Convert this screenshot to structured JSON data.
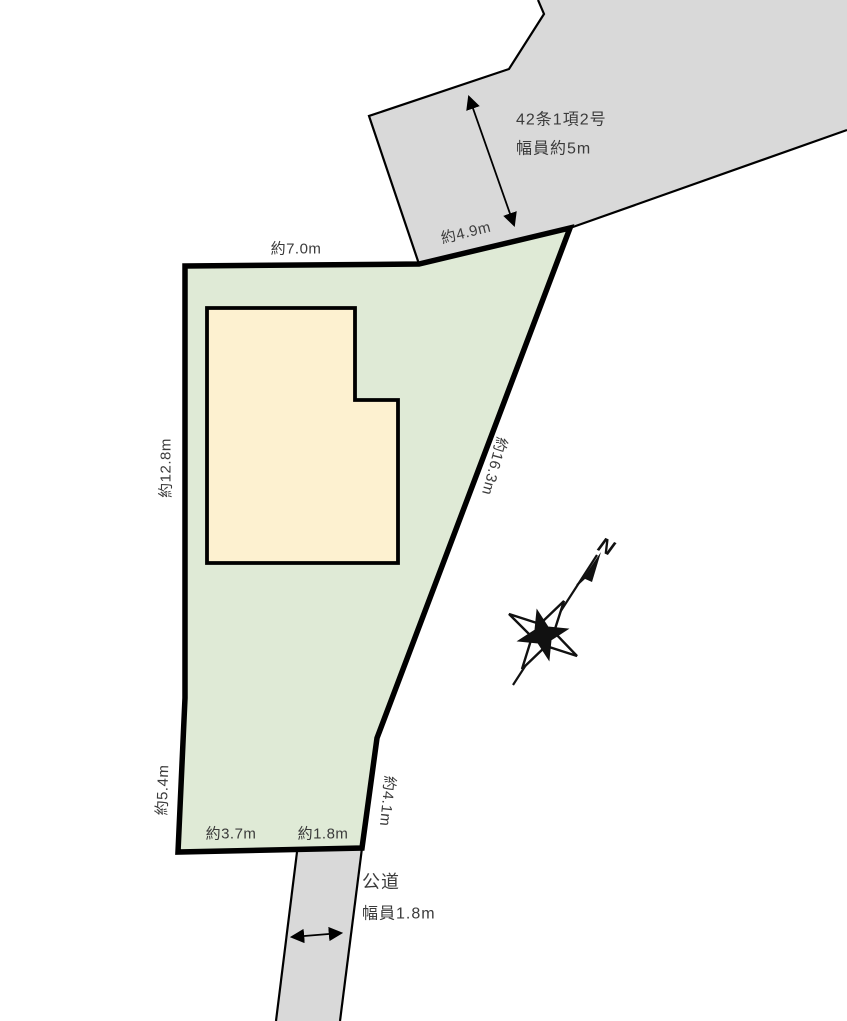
{
  "colors": {
    "road_fill": "#d9d9d9",
    "parcel_fill": "#dfead6",
    "building_fill": "#fdf1d0",
    "outline": "#000000",
    "label": "#3b3b3b"
  },
  "top_road": {
    "regulation": "42条1項2号",
    "width": "幅員約5m",
    "frontage": "約4.9m"
  },
  "bottom_road": {
    "type": "公道",
    "width": "幅員1.8m"
  },
  "parcel": {
    "top": "約7.0m",
    "left_upper": "約12.8m",
    "left_lower": "約5.4m",
    "right_upper": "約16.3m",
    "right_lower": "約4.1m",
    "bottom_left": "約3.7m",
    "bottom_right": "約1.8m"
  },
  "compass": {
    "north": "N"
  }
}
